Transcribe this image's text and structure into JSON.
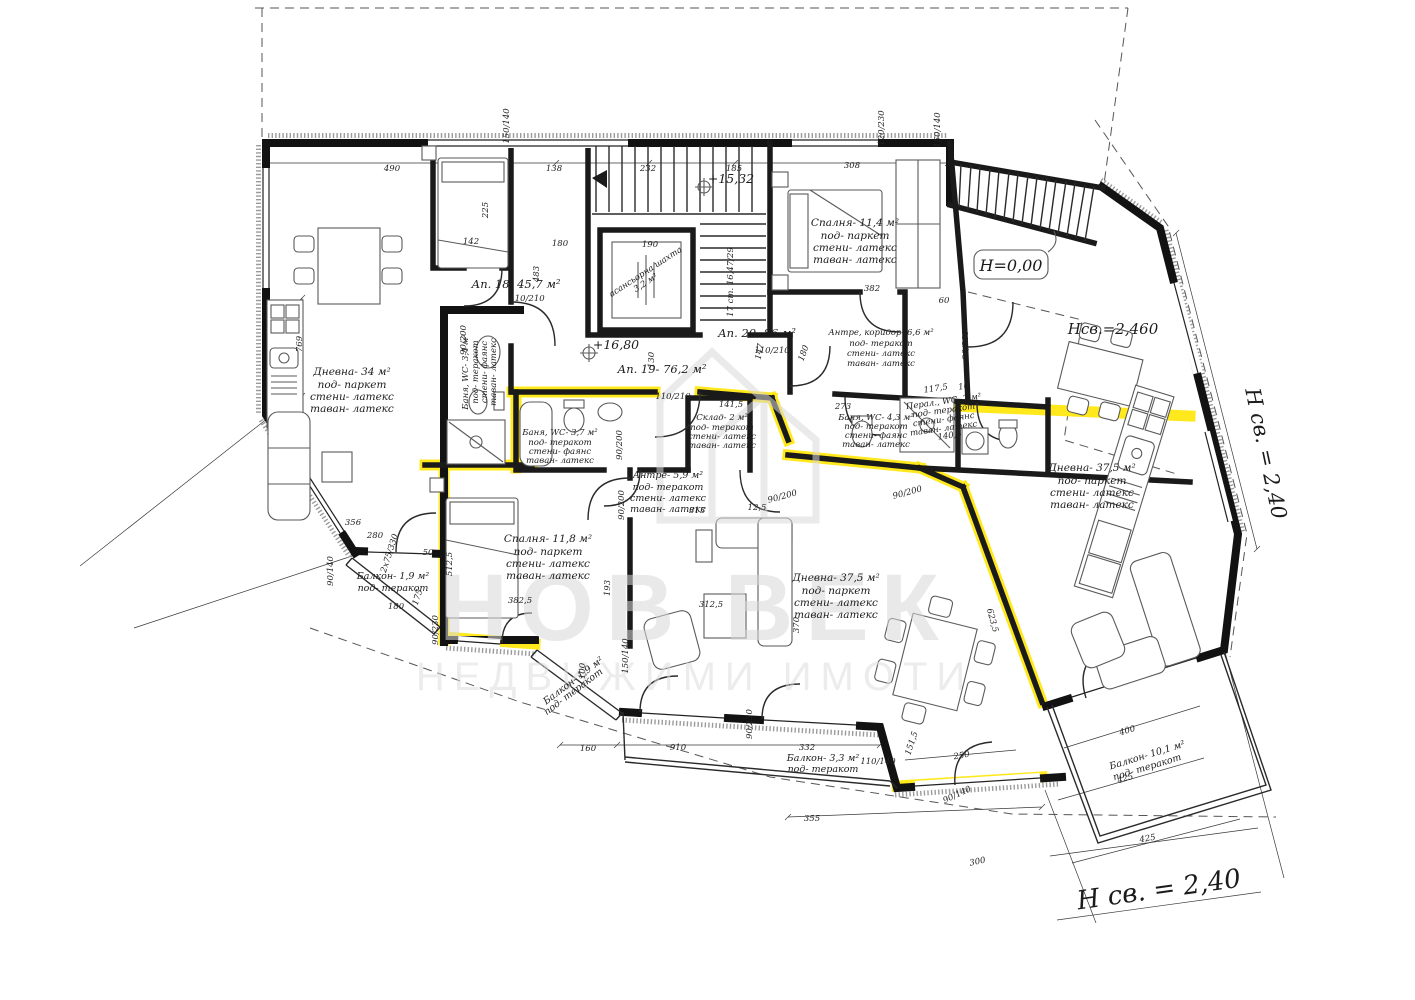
{
  "watermark": {
    "line1": "НОВ ВЕК",
    "line2": "НЕДВИЖИМИ ИМОТИ"
  },
  "apartments": {
    "ap18": "Ап. 18- 45,7 м²",
    "ap19": "Ап. 19- 76,2 м²",
    "ap20": "Ап. 20- 86 м²"
  },
  "rooms": {
    "living34": [
      "Дневна- 34 м²",
      "под- паркет",
      "стени- латекс",
      "таван- латекс"
    ],
    "bedroom114": [
      "Спалня- 11,4 м²",
      "под- паркет",
      "стени- латекс",
      "таван- латекс"
    ],
    "bedroom118": [
      "Спалня- 11,8 м²",
      "под- паркет",
      "стени- латекс",
      "таван- латекс"
    ],
    "living375mid": [
      "Дневна- 37,5 м²",
      "под- паркет",
      "стени- латекс",
      "таван- латекс"
    ],
    "living375right": [
      "Дневна- 37,5 м²",
      "под- паркет",
      "стени- латекс",
      "таван- латекс"
    ],
    "hall66": [
      "Антре, коридор- 6,6 м²",
      "под- теракот",
      "стени- латекс",
      "таван- латекс"
    ],
    "hall59": [
      "Антре- 5,9 м²",
      "под- теракот",
      "стени- латекс",
      "таван- латекс"
    ],
    "bath34": [
      "Баня, WC- 3,4 м²",
      "под- теракот",
      "стени- фаянс",
      "таван- латекс"
    ],
    "bath37": [
      "Баня, WC- 3,7 м²",
      "под- теракот",
      "стени- фаянс",
      "таван- латекс"
    ],
    "bath43": [
      "Баня, WC- 4,3 м²",
      "под- теракот",
      "стени- фаянс",
      "таван- латекс"
    ],
    "laundry": [
      "Перал., WC- 2 м²",
      "под- теракот",
      "стени- фаянс",
      "таван- латекс"
    ],
    "storage": [
      "Склад- 2 м²",
      "под- теракот",
      "стени- латекс",
      "таван- латекс"
    ],
    "balcony19a": [
      "Балкон- 1,9 м²",
      "под- теракот"
    ],
    "balcony19b": [
      "Балкон- 1,9 м²",
      "под- теракот"
    ],
    "balcony33": [
      "Балкон- 3,3 м²",
      "под- теракот"
    ],
    "balcony101": [
      "Балкон- 10,1 м²",
      "под- теракот"
    ],
    "elevator": [
      "асансьорна шахта",
      "3,2 м²"
    ]
  },
  "elevations": {
    "h000": "H=0,00",
    "h1532": "+15,32",
    "h1680": "+16,80",
    "hsv2460": "Нсв.=2,460",
    "hsv240_right": "Н св. = 2,40",
    "hsv240_bottom": "Н св. = 2,40"
  },
  "stairs": {
    "note": "17 ст. 16,47/29"
  },
  "dims": {
    "t490": "490",
    "t138": "138",
    "t232": "232",
    "t185": "185",
    "t308": "308",
    "f150140a": "150/140",
    "f120230": "120/230",
    "f150140b": "150/140",
    "f150140c": "150/140",
    "v769": "769",
    "t356": "356",
    "t280": "280",
    "t180a": "180",
    "v175": "175",
    "f90140a": "90/140",
    "f90140b": "90/140",
    "t180b": "180",
    "t190": "190",
    "t142": "142",
    "v225": "225",
    "v483": "483",
    "t382": "382",
    "t60": "60",
    "v130": "130",
    "v147": "147",
    "v180c": "180",
    "t313": "313",
    "t125": "12,5",
    "t1415": "141,5",
    "t273": "273",
    "t1175": "117,5",
    "t10": "10",
    "t1405": "140,5",
    "f90200a": "90/200",
    "f90200b": "90/200",
    "f90200c": "90/200",
    "f90200d": "90/200",
    "f90200e": "90/200",
    "f90200f": "90/200",
    "f110210a": "110/210",
    "f110210b": "110/210",
    "f110210c": "110/210",
    "f110140": "110/140",
    "f90230a": "90/230",
    "f90230b": "90/230",
    "f2x75": "2х75/330",
    "t3825": "382,5",
    "t3125": "312,5",
    "v5125": "512,5",
    "v193": "193",
    "v370": "370",
    "v100": "100",
    "t160": "160",
    "t910": "910",
    "t332": "332",
    "t355": "355",
    "t250": "250",
    "t300": "300",
    "t400": "400",
    "t425a": "425",
    "t425b": "425",
    "v6235": "623,5",
    "v1515": "151,5",
    "t50": "50"
  }
}
